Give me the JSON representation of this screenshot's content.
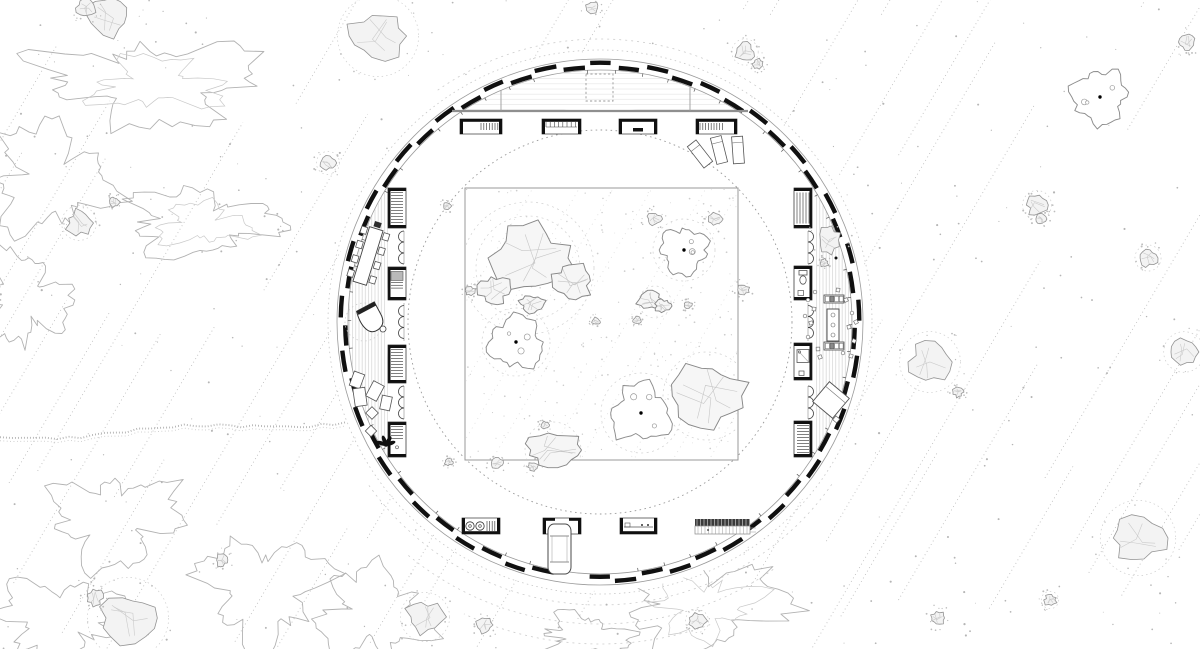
{
  "meta": {
    "title": "Circular pavilion floor plan with zen-garden courtyard on a stippled hillside site",
    "canvas": {
      "w": 1200,
      "h": 649
    },
    "colors": {
      "ink": "#101010",
      "line": "#9a9a9a",
      "faint": "#c9c9c9",
      "stipple": "#b5b5b5",
      "rock_fill": "#f3f3f3",
      "floor_stripe": "#d3d3d3",
      "beam_gray": "#8f8f8f"
    }
  },
  "ring": {
    "cx": 600,
    "cy": 322,
    "r_outer_wall": 263,
    "r_inner_wall": 252,
    "r_outer_dotted": 272,
    "r_court_dotted": 192,
    "r_band_inner": 215,
    "wall_segments": 58,
    "segment_fill": 0.76,
    "stagger_radii": [
      259.3,
      254.8
    ]
  },
  "top_structure": {
    "beam_y": 111,
    "beam_x1": 452,
    "beam_x2": 748,
    "posts_x": [
      501,
      690
    ],
    "skylight": {
      "x": 586,
      "y": 74,
      "w": 27,
      "h": 27
    }
  },
  "courtyard": {
    "x": 465,
    "y": 188,
    "w": 273,
    "h": 272,
    "trees": [
      {
        "x": 684,
        "y": 250,
        "r": 23
      },
      {
        "x": 516,
        "y": 342,
        "r": 26
      },
      {
        "x": 641,
        "y": 413,
        "r": 29
      }
    ],
    "boulders": [
      {
        "x": 530,
        "y": 258,
        "rx": 38,
        "ry": 32
      },
      {
        "x": 494,
        "y": 290,
        "rx": 16,
        "ry": 13
      },
      {
        "x": 572,
        "y": 281,
        "rx": 19,
        "ry": 17
      },
      {
        "x": 532,
        "y": 304,
        "rx": 12,
        "ry": 8
      },
      {
        "x": 707,
        "y": 396,
        "rx": 36,
        "ry": 32
      },
      {
        "x": 553,
        "y": 450,
        "rx": 27,
        "ry": 17
      },
      {
        "x": 650,
        "y": 300,
        "rx": 12,
        "ry": 9
      },
      {
        "x": 663,
        "y": 306,
        "rx": 8,
        "ry": 6
      }
    ],
    "stones": [
      {
        "x": 654,
        "y": 219,
        "r": 7
      },
      {
        "x": 715,
        "y": 219,
        "r": 7
      },
      {
        "x": 743,
        "y": 290,
        "r": 6
      },
      {
        "x": 596,
        "y": 321,
        "r": 4
      },
      {
        "x": 637,
        "y": 320,
        "r": 4
      },
      {
        "x": 470,
        "y": 291,
        "r": 5
      },
      {
        "x": 447,
        "y": 206,
        "r": 4
      },
      {
        "x": 449,
        "y": 462,
        "r": 4
      },
      {
        "x": 497,
        "y": 463,
        "r": 6
      },
      {
        "x": 533,
        "y": 467,
        "r": 5
      },
      {
        "x": 545,
        "y": 425,
        "r": 4
      },
      {
        "x": 688,
        "y": 305,
        "r": 4
      }
    ],
    "ripples": [
      {
        "x": 528,
        "y": 268,
        "r": 52
      },
      {
        "x": 528,
        "y": 268,
        "r": 66
      },
      {
        "x": 707,
        "y": 396,
        "r": 44
      },
      {
        "x": 516,
        "y": 342,
        "r": 34
      },
      {
        "x": 655,
        "y": 302,
        "r": 16
      },
      {
        "x": 641,
        "y": 413,
        "r": 40
      },
      {
        "x": 553,
        "y": 450,
        "r": 28
      },
      {
        "x": 684,
        "y": 250,
        "r": 31
      }
    ]
  },
  "rooms": {
    "left": [
      {
        "x": 388,
        "y": 188,
        "w": 18,
        "h": 40,
        "kind": "shelf_h"
      },
      {
        "x": 388,
        "y": 267,
        "w": 18,
        "h": 33,
        "kind": "appliance"
      },
      {
        "x": 388,
        "y": 345,
        "w": 18,
        "h": 38,
        "kind": "shelf_h"
      },
      {
        "x": 388,
        "y": 422,
        "w": 18,
        "h": 35,
        "kind": "wardrobe"
      }
    ],
    "right": [
      {
        "x": 794,
        "y": 188,
        "w": 18,
        "h": 40,
        "kind": "shelf_v"
      },
      {
        "x": 794,
        "y": 266,
        "w": 18,
        "h": 34,
        "kind": "wc"
      },
      {
        "x": 794,
        "y": 343,
        "w": 18,
        "h": 37,
        "kind": "shower"
      },
      {
        "x": 794,
        "y": 421,
        "w": 18,
        "h": 36,
        "kind": "shelf_h"
      }
    ],
    "top": [
      {
        "x": 460,
        "y": 119,
        "w": 42,
        "h": 15,
        "kind": "counter_hatch_right"
      },
      {
        "x": 542,
        "y": 119,
        "w": 39,
        "h": 15,
        "kind": "cell_row"
      },
      {
        "x": 619,
        "y": 119,
        "w": 38,
        "h": 15,
        "kind": "counter_plain"
      },
      {
        "x": 696,
        "y": 119,
        "w": 41,
        "h": 15,
        "kind": "counter_hatch_left"
      }
    ],
    "bottom": [
      {
        "x": 462,
        "y": 518,
        "w": 38,
        "h": 16,
        "kind": "laundry"
      },
      {
        "x": 543,
        "y": 518,
        "w": 38,
        "h": 16,
        "kind": "garage"
      },
      {
        "x": 620,
        "y": 518,
        "w": 37,
        "h": 16,
        "kind": "counter_sink"
      },
      {
        "x": 695,
        "y": 519,
        "w": 55,
        "h": 15,
        "kind": "stairs"
      }
    ],
    "scallop_gaps_y": [
      [
        231,
        264
      ],
      [
        303,
        341
      ],
      [
        386,
        419
      ]
    ],
    "scallop_left_x": 404,
    "scallop_right_x": 808,
    "scallop_r": 5.5
  },
  "furniture": {
    "dining_table": {
      "x": 368,
      "y": 256,
      "w": 14,
      "l": 57,
      "rot": 17,
      "chairs_per_side": 4
    },
    "piano": {
      "x": 372,
      "y": 319,
      "rot": -28,
      "halo_r": 19
    },
    "loungers": [
      {
        "x": 357,
        "y": 380,
        "w": 11,
        "h": 15,
        "rot": 20
      },
      {
        "x": 360,
        "y": 397,
        "w": 12,
        "h": 18,
        "rot": -8
      },
      {
        "x": 375,
        "y": 391,
        "w": 12,
        "h": 17,
        "rot": 28
      },
      {
        "x": 372,
        "y": 413,
        "w": 9,
        "h": 9,
        "rot": 45
      },
      {
        "x": 371,
        "y": 431,
        "w": 8,
        "h": 8,
        "rot": 45
      },
      {
        "x": 386,
        "y": 403,
        "w": 10,
        "h": 14,
        "rot": 12
      }
    ],
    "plant": {
      "x": 386,
      "y": 445
    },
    "chaises": [
      {
        "x": 700,
        "y": 154,
        "w": 11,
        "h": 27,
        "rot": -38
      },
      {
        "x": 719,
        "y": 150,
        "w": 11,
        "h": 27,
        "rot": -14
      },
      {
        "x": 738,
        "y": 150,
        "w": 11,
        "h": 27,
        "rot": -4
      }
    ],
    "kitchen": {
      "stoves": [
        {
          "x": 824,
          "y": 295,
          "w": 20,
          "h": 8
        },
        {
          "x": 824,
          "y": 342,
          "w": 20,
          "h": 8
        }
      ],
      "table": {
        "x": 827,
        "y": 309,
        "w": 12,
        "h": 32
      },
      "stools": [
        [
          808,
          300
        ],
        [
          814,
          309
        ],
        [
          811,
          323
        ],
        [
          808,
          337
        ],
        [
          818,
          349
        ],
        [
          846,
          300
        ],
        [
          852,
          313
        ],
        [
          849,
          327
        ],
        [
          854,
          341
        ],
        [
          843,
          353
        ],
        [
          820,
          357
        ],
        [
          851,
          356
        ],
        [
          805,
          316
        ],
        [
          856,
          322
        ],
        [
          838,
          290
        ],
        [
          815,
          292
        ]
      ]
    },
    "bed": {
      "x": 831,
      "y": 400,
      "size": 26,
      "rot": 40
    },
    "car": {
      "x": 548,
      "y": 524,
      "w": 23,
      "h": 50
    },
    "band_rock": {
      "x": 829,
      "y": 240,
      "rx": 10,
      "ry": 13
    },
    "band_rock2": {
      "x": 824,
      "y": 263,
      "r": 4
    }
  },
  "terrain": {
    "hatch": {
      "angle_deg": -59.5,
      "spacing": 37,
      "color": "#bcbcbc"
    },
    "square_hatch_lines": 12,
    "trees": [
      {
        "x": 1100,
        "y": 97,
        "r": 26
      }
    ],
    "rocks": [
      {
        "x": 378,
        "y": 36,
        "r": 28,
        "halo": true
      },
      {
        "x": 108,
        "y": 16,
        "r": 20
      },
      {
        "x": 86,
        "y": 8,
        "r": 9
      },
      {
        "x": 745,
        "y": 52,
        "r": 9,
        "halo": true
      },
      {
        "x": 758,
        "y": 64,
        "r": 5
      },
      {
        "x": 328,
        "y": 163,
        "r": 8,
        "halo": true
      },
      {
        "x": 79,
        "y": 223,
        "r": 12,
        "halo": true
      },
      {
        "x": 114,
        "y": 202,
        "r": 5
      },
      {
        "x": 1037,
        "y": 205,
        "r": 10,
        "halo": true
      },
      {
        "x": 1041,
        "y": 219,
        "r": 5
      },
      {
        "x": 1148,
        "y": 258,
        "r": 9,
        "halo": true
      },
      {
        "x": 930,
        "y": 362,
        "r": 21,
        "halo": true
      },
      {
        "x": 958,
        "y": 392,
        "r": 5
      },
      {
        "x": 1184,
        "y": 352,
        "r": 14,
        "halo": true
      },
      {
        "x": 1138,
        "y": 538,
        "r": 26,
        "halo": true
      },
      {
        "x": 1050,
        "y": 600,
        "r": 6,
        "halo": true
      },
      {
        "x": 128,
        "y": 618,
        "r": 28,
        "halo": true
      },
      {
        "x": 95,
        "y": 598,
        "r": 8
      },
      {
        "x": 425,
        "y": 617,
        "r": 17,
        "halo": true
      },
      {
        "x": 484,
        "y": 625,
        "r": 8
      },
      {
        "x": 697,
        "y": 621,
        "r": 8,
        "halo": true
      },
      {
        "x": 938,
        "y": 618,
        "r": 7
      },
      {
        "x": 222,
        "y": 560,
        "r": 6
      },
      {
        "x": 1187,
        "y": 42,
        "r": 8
      },
      {
        "x": 592,
        "y": 8,
        "r": 6
      }
    ],
    "contours": [
      {
        "cx": 150,
        "cy": 82,
        "rx": 95,
        "ry": 38
      },
      {
        "cx": 52,
        "cy": 180,
        "rx": 55,
        "ry": 48
      },
      {
        "cx": 200,
        "cy": 222,
        "rx": 68,
        "ry": 30
      },
      {
        "cx": 25,
        "cy": 300,
        "rx": 38,
        "ry": 42
      },
      {
        "cx": 115,
        "cy": 520,
        "rx": 58,
        "ry": 42
      },
      {
        "cx": 262,
        "cy": 588,
        "rx": 55,
        "ry": 48
      },
      {
        "cx": 372,
        "cy": 614,
        "rx": 48,
        "ry": 40
      },
      {
        "cx": 60,
        "cy": 618,
        "rx": 55,
        "ry": 35
      },
      {
        "cx": 700,
        "cy": 604,
        "rx": 72,
        "ry": 45
      },
      {
        "cx": 585,
        "cy": 638,
        "rx": 40,
        "ry": 22
      }
    ],
    "trail": {
      "from": [
        0,
        438
      ],
      "to": [
        345,
        421
      ],
      "segments": 30,
      "amp": 3.2
    },
    "outer_arcs": [
      {
        "r": 283,
        "a0": 35,
        "a1": 145
      },
      {
        "r": 302,
        "a0": 55,
        "a1": 130
      },
      {
        "r": 322,
        "a0": 70,
        "a1": 115
      },
      {
        "r": 283,
        "a0": 235,
        "a1": 305
      }
    ],
    "stipple_count": 520,
    "square_stipple_count": 240
  }
}
